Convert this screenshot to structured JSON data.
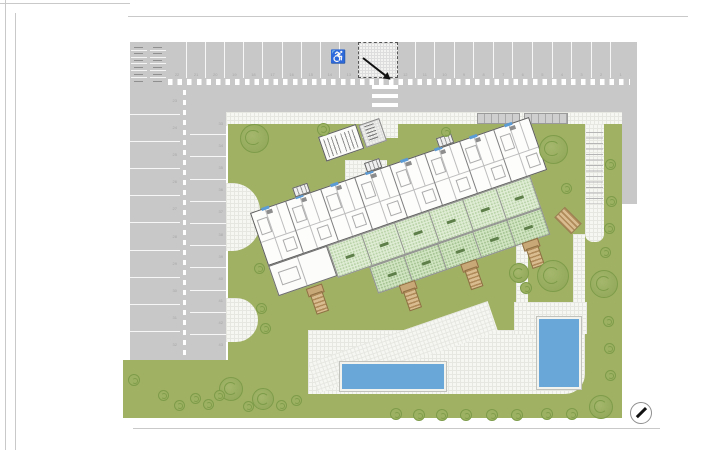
{
  "title": "residential-site-plan",
  "colors": {
    "asphalt": "#c8c8c8",
    "grass": "#a0b164",
    "treeline": "#7d9c49",
    "terrace_light": "#e0edd5",
    "terrace_green": "#d2e5c3",
    "pool": "#68a7d8",
    "accent": "#5b9bd5",
    "stair_tan": "#c9a877",
    "paving": "#f6f6f3",
    "line": "#5e5e5e"
  },
  "icons": {
    "wheelchair_glyph": "♿",
    "north_arrow": "north-arrow-icon"
  },
  "parking": {
    "moto_stall_rows": 6,
    "top_stalls_left_numbers": [
      "22",
      "21",
      "20",
      "19",
      "18",
      "17",
      "16",
      "15",
      "14",
      "13"
    ],
    "top_stalls_right_numbers": [
      "12",
      "11",
      "10",
      "9",
      "8",
      "7",
      "6",
      "5",
      "4",
      "3",
      "2",
      "1"
    ],
    "left_column_numbers": [
      "23",
      "24",
      "25",
      "26",
      "27",
      "28",
      "29",
      "30",
      "31",
      "32"
    ],
    "right_column_numbers": [
      "33",
      "34",
      "35",
      "36",
      "37",
      "38",
      "39",
      "40",
      "41",
      "42",
      "43"
    ]
  },
  "building": {
    "unit_count": 8,
    "terrace_cells": 6,
    "garden_cells": 5,
    "cores_x": [
      48,
      124,
      200
    ],
    "stairs": [
      [
        28,
        90
      ],
      [
        117,
        117
      ],
      [
        182,
        117
      ],
      [
        247,
        117
      ]
    ]
  },
  "pools": [
    {
      "x": 340,
      "y": 362,
      "w": 102,
      "h": 25
    },
    {
      "x": 537,
      "y": 317,
      "w": 40,
      "h": 68
    }
  ],
  "pergolas": [
    {
      "x": 477,
      "y": 113,
      "w": 41,
      "h": 9
    },
    {
      "x": 524,
      "y": 113,
      "w": 42,
      "h": 9
    }
  ],
  "trees": [
    [
      253,
      137,
      27
    ],
    [
      552,
      148,
      27
    ],
    [
      552,
      275,
      30
    ],
    [
      518,
      272,
      18
    ],
    [
      603,
      283,
      26
    ],
    [
      230,
      388,
      22
    ],
    [
      262,
      398,
      20
    ],
    [
      600,
      406,
      22
    ]
  ],
  "bushes": [
    [
      322,
      128,
      11
    ],
    [
      445,
      131,
      8
    ],
    [
      609,
      163,
      9
    ],
    [
      565,
      187,
      9
    ],
    [
      610,
      200,
      9
    ],
    [
      608,
      227,
      9
    ],
    [
      604,
      251,
      9
    ],
    [
      525,
      287,
      10
    ],
    [
      607,
      320,
      9
    ],
    [
      608,
      347,
      9
    ],
    [
      609,
      374,
      9
    ],
    [
      258,
      267,
      9
    ],
    [
      260,
      307,
      9
    ],
    [
      264,
      327,
      9
    ],
    [
      133,
      379,
      10
    ],
    [
      162,
      394,
      9
    ],
    [
      178,
      404,
      9
    ],
    [
      194,
      397,
      9
    ],
    [
      207,
      403,
      9
    ],
    [
      218,
      394,
      9
    ],
    [
      247,
      405,
      9
    ],
    [
      280,
      404,
      9
    ],
    [
      295,
      399,
      9
    ],
    [
      395,
      413,
      10
    ],
    [
      418,
      414,
      10
    ],
    [
      441,
      414,
      10
    ],
    [
      465,
      414,
      10
    ],
    [
      491,
      414,
      10
    ],
    [
      516,
      414,
      10
    ],
    [
      546,
      413,
      10
    ],
    [
      571,
      413,
      10
    ]
  ]
}
